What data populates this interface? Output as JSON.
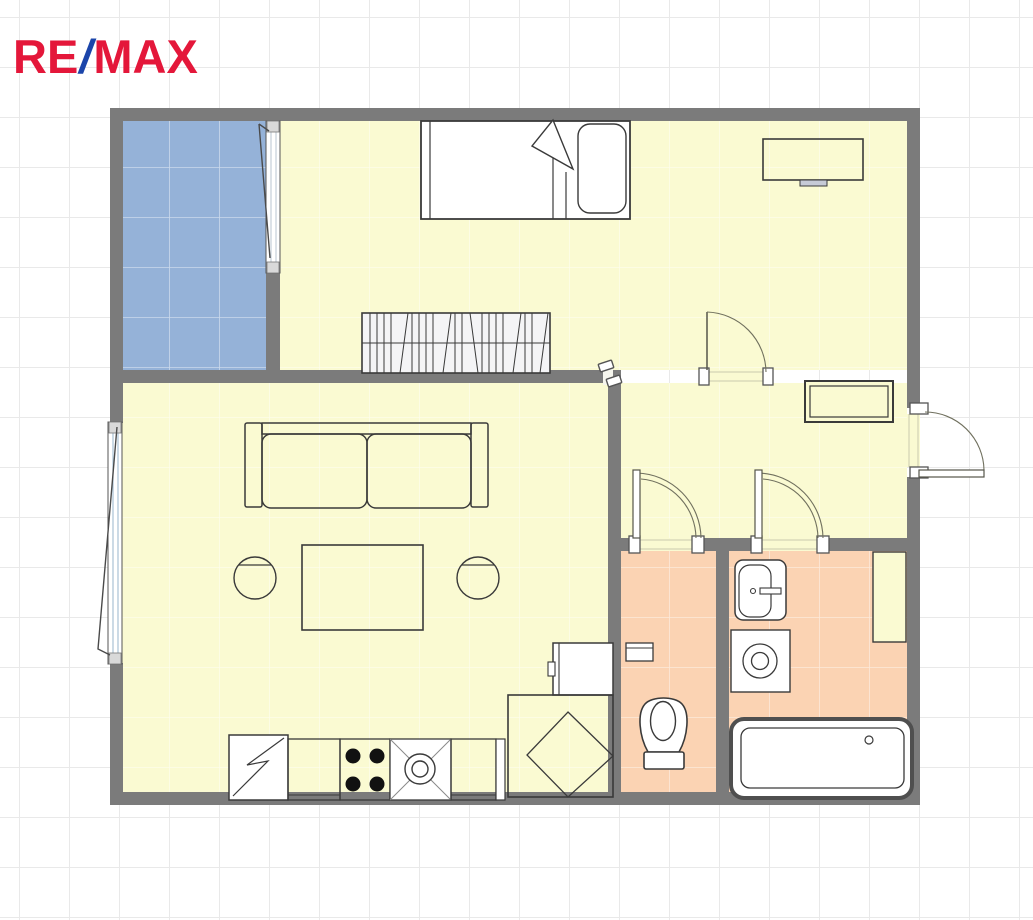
{
  "logo": {
    "re": "RE",
    "slash": "/",
    "max": "MAX"
  },
  "colors": {
    "logo_red": "#e4173a",
    "logo_blue": "#1b45aa",
    "wall": "#7b7b7b",
    "room_yellow": "#fafad2",
    "balcony_blue": "#95b2d8",
    "wet_room_salmon": "#fbd3b3",
    "furniture_line": "#3a3a3a",
    "door_arc": "#70705e",
    "grid_line": "#e9e9e9",
    "desk_tab_gray": "#c6cad6",
    "jamb_light": "#d9d9d9",
    "window_glass": "#a9c2d4"
  }
}
